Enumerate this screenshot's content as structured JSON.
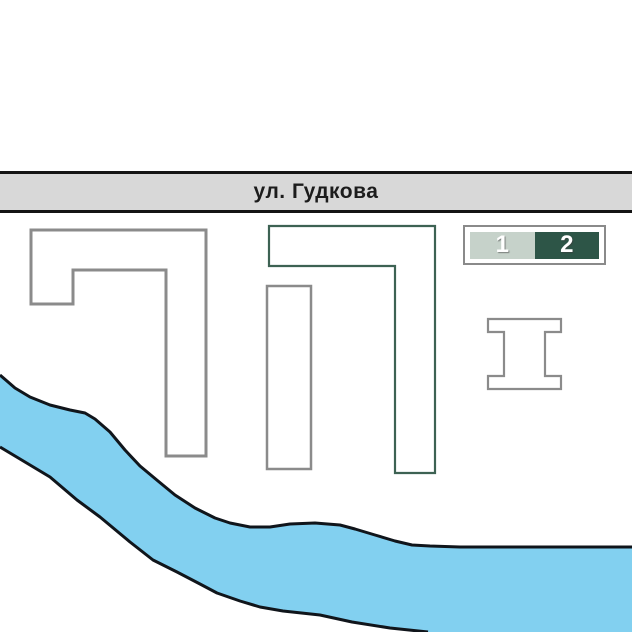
{
  "street": {
    "label": "ул. Гудкова"
  },
  "legend": {
    "item1": {
      "label": "1",
      "state": "inactive"
    },
    "item2": {
      "label": "2",
      "state": "active"
    }
  },
  "colors": {
    "street_fill": "#d8d8d8",
    "street_border": "#141414",
    "street_text": "#1c1c1c",
    "river_fill": "#82d0f0",
    "river_outline": "#10151b",
    "building_gray_outline": "#8b8b8b",
    "building_green_outline": "#3d6253",
    "building_fill": "#ffffff",
    "legend_item1_fill": "#c6d2ca",
    "legend_item2_fill": "#2d5547",
    "legend_text": "#ffffff",
    "legend_border": "#8a8a8a"
  }
}
